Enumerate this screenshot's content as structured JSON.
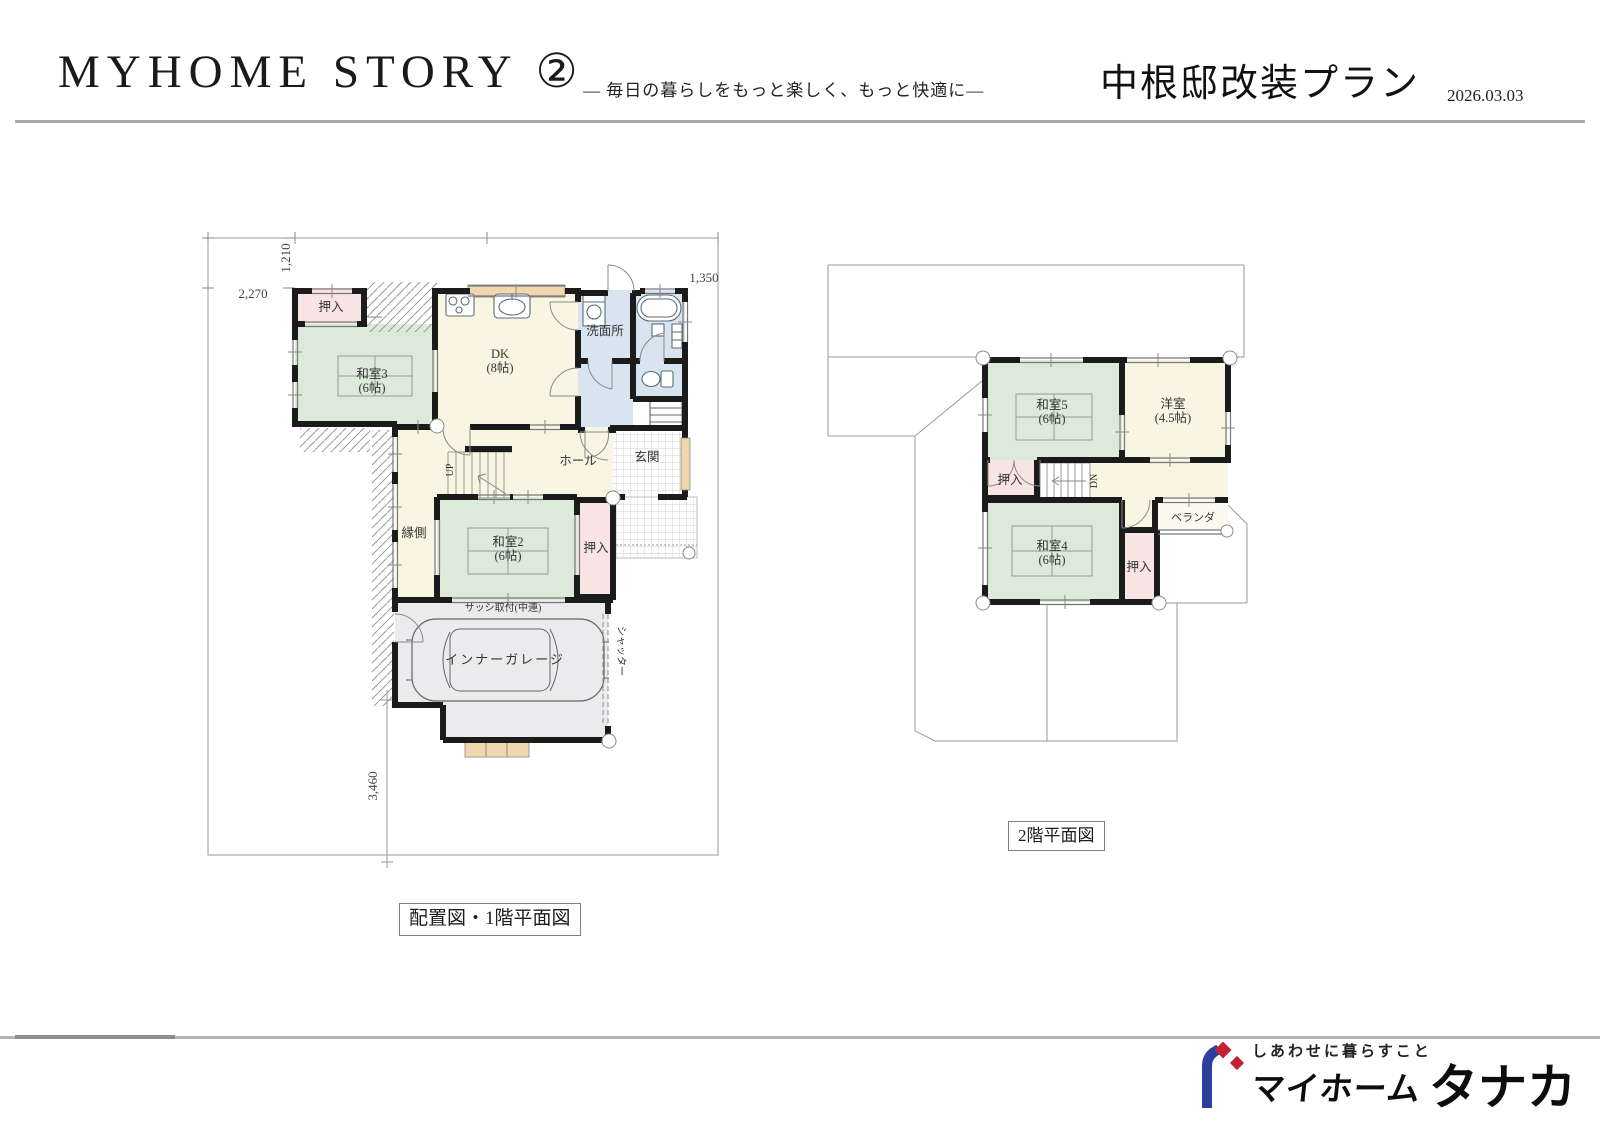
{
  "header": {
    "title": "MYHOME STORY ②",
    "subtitle": "― 毎日の暮らしをもっと楽しく、もっと快適に―",
    "plan_title": "中根邸改装プラン",
    "date": "2026.03.03"
  },
  "f1": {
    "caption": "配置図・1階平面図",
    "d1210": "1,210",
    "d2270": "2,270",
    "d1350": "1,350",
    "d3460": "3,460",
    "oshiire_a": "押入",
    "washitsu3": "和室3",
    "washitsu3_s": "(6帖)",
    "dk": "DK",
    "dk_s": "(8帖)",
    "senmenjo": "洗面所",
    "hall": "ホール",
    "genkan": "玄関",
    "engawa": "縁側",
    "washitsu2": "和室2",
    "washitsu2_s": "(6帖)",
    "oshiire_b": "押入",
    "sash": "サッシ取付(中連)",
    "garage": "インナーガレージ",
    "shutter": "シャッター",
    "up": "UP"
  },
  "f2": {
    "caption": "2階平面図",
    "washitsu5": "和室5",
    "washitsu5_s": "(6帖)",
    "yoshitsu": "洋室",
    "yoshitsu_s": "(4.5帖)",
    "oshiire_a": "押入",
    "dn": "DN",
    "veranda": "ベランダ",
    "washitsu4": "和室4",
    "washitsu4_s": "(6帖)",
    "oshiire_b": "押入"
  },
  "footer": {
    "tagline": "しあわせに暮らすこと",
    "brand_myhome": "マイホーム",
    "brand_tanaka": "タナカ"
  },
  "colors": {
    "tatami_green": "#dcead9",
    "floor_cream": "#f8f5e3",
    "closet_pink": "#f8e5e3",
    "wet_blue": "#d9e4f1",
    "garage_gray": "#ebebed",
    "wood_tan": "#f0d8ae",
    "wall_black": "#1b1b1b",
    "logo_blue": "#2a3f9e",
    "logo_red": "#c22233"
  }
}
